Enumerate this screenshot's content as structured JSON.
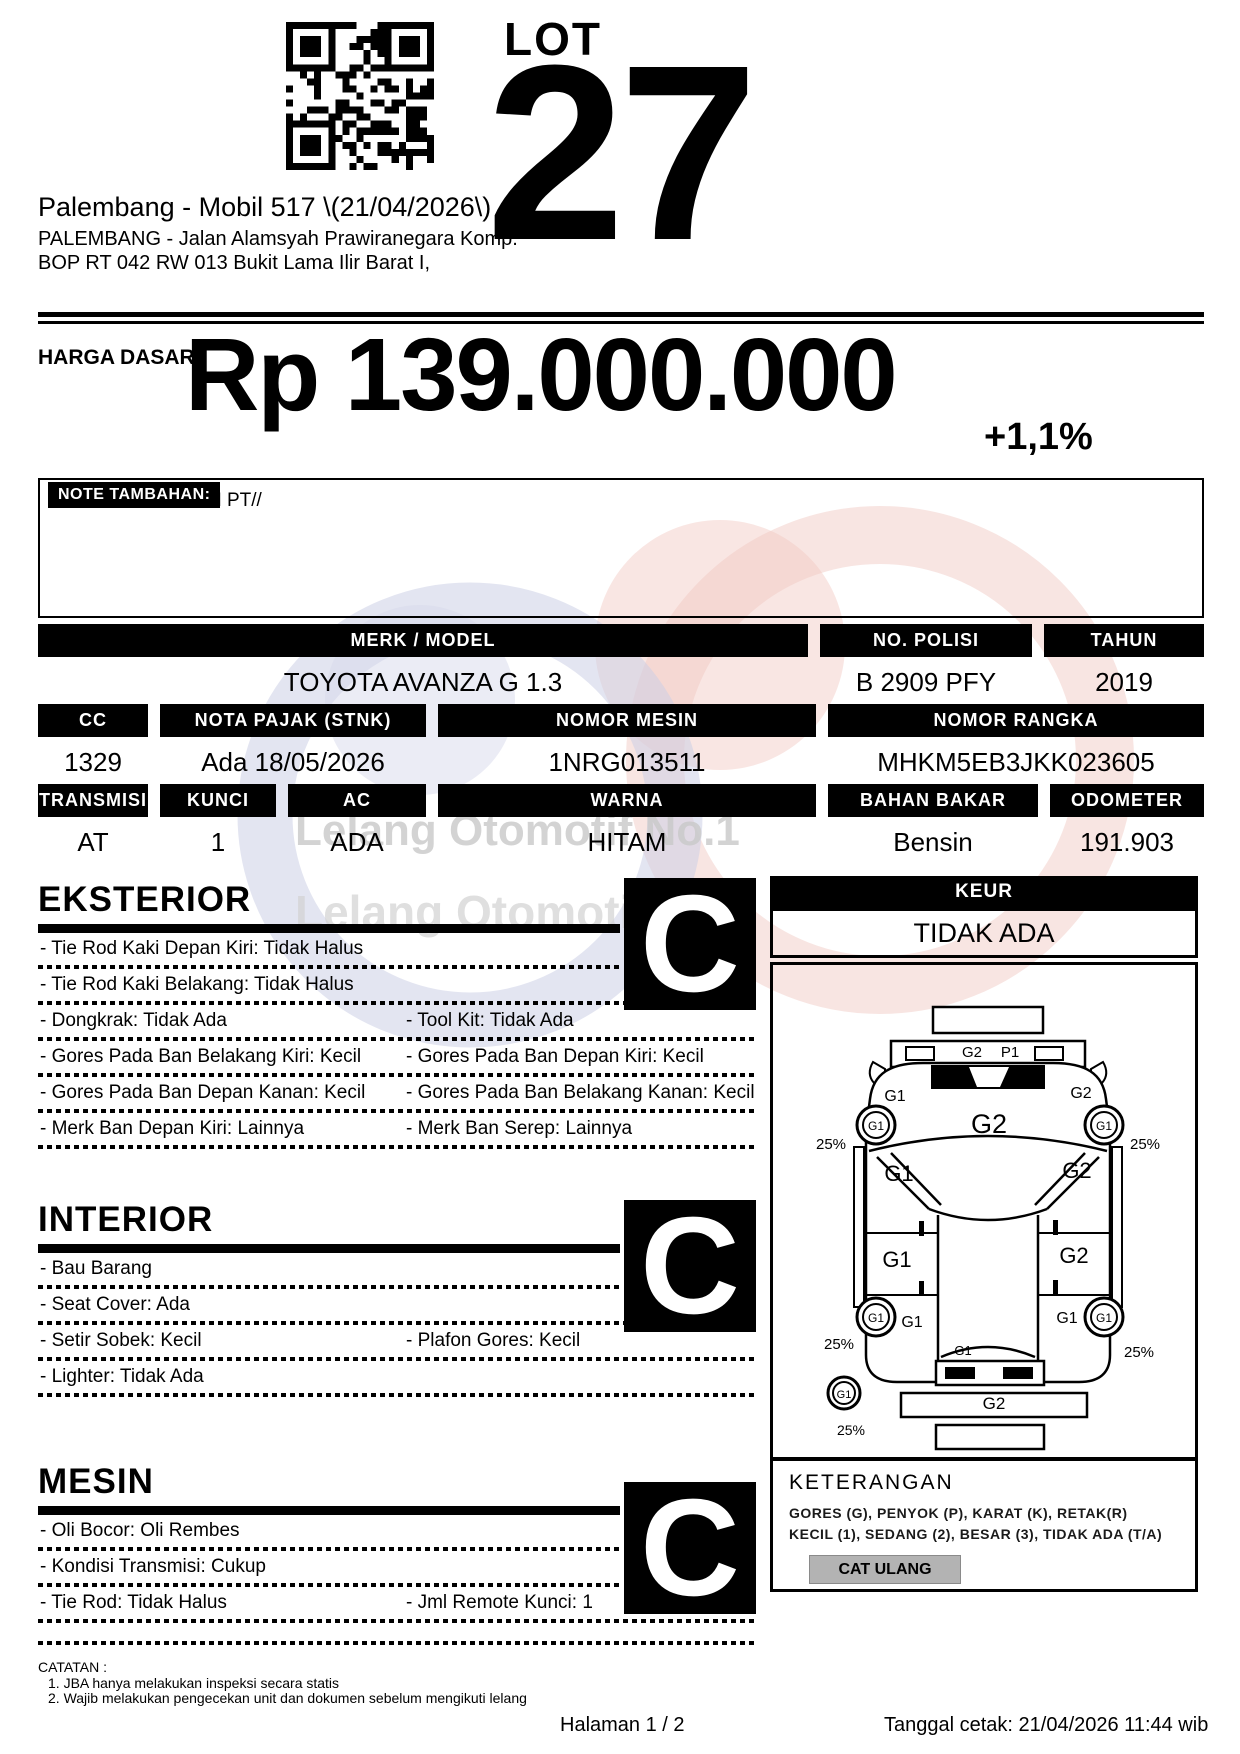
{
  "header": {
    "lot_label": "LOT",
    "lot_number": "27",
    "title": "Palembang - Mobil 517 \\(21/04/2026\\)",
    "address1": "PALEMBANG - Jalan Alamsyah Prawiranegara Komp.",
    "address2": "BOP RT 042 RW 013 Bukit Lama Ilir Barat I,"
  },
  "price": {
    "label": "HARGA DASAR :",
    "value": "Rp 139.000.000",
    "change": "+1,1%"
  },
  "note": {
    "label": "NOTE TAMBAHAN:",
    "text": "A.N PT//"
  },
  "specs": {
    "merk_model": {
      "label": "MERK / MODEL",
      "value": "TOYOTA AVANZA G 1.3"
    },
    "no_polisi": {
      "label": "NO. POLISI",
      "value": "B 2909 PFY"
    },
    "tahun": {
      "label": "TAHUN",
      "value": "2019"
    },
    "cc": {
      "label": "CC",
      "value": "1329"
    },
    "nota_pajak": {
      "label": "NOTA PAJAK (STNK)",
      "value": "Ada 18/05/2026"
    },
    "nomor_mesin": {
      "label": "NOMOR MESIN",
      "value": "1NRG013511"
    },
    "nomor_rangka": {
      "label": "NOMOR RANGKA",
      "value": "MHKM5EB3JKK023605"
    },
    "transmisi": {
      "label": "TRANSMISI",
      "value": "AT"
    },
    "kunci": {
      "label": "KUNCI",
      "value": "1"
    },
    "ac": {
      "label": "AC",
      "value": "ADA"
    },
    "warna": {
      "label": "WARNA",
      "value": "HITAM"
    },
    "bahan_bakar": {
      "label": "BAHAN BAKAR",
      "value": "Bensin"
    },
    "odometer": {
      "label": "ODOMETER",
      "value": "191.903"
    }
  },
  "sections": {
    "eksterior": {
      "title": "EKSTERIOR",
      "grade": "C",
      "rows": [
        {
          "left": "- Tie Rod Kaki Depan Kiri: Tidak Halus",
          "right": ""
        },
        {
          "left": "- Tie Rod Kaki Belakang: Tidak Halus",
          "right": ""
        },
        {
          "left": "- Dongkrak: Tidak Ada",
          "right": "- Tool Kit: Tidak Ada"
        },
        {
          "left": "- Gores Pada Ban Belakang Kiri: Kecil",
          "right": "- Gores Pada Ban Depan Kiri: Kecil"
        },
        {
          "left": "- Gores Pada Ban Depan Kanan: Kecil",
          "right": "- Gores Pada Ban Belakang Kanan: Kecil"
        },
        {
          "left": "- Merk Ban Depan Kiri: Lainnya",
          "right": "- Merk Ban Serep: Lainnya"
        }
      ]
    },
    "interior": {
      "title": "INTERIOR",
      "grade": "C",
      "rows": [
        {
          "left": "- Bau Barang",
          "right": ""
        },
        {
          "left": "- Seat Cover: Ada",
          "right": ""
        },
        {
          "left": "- Setir Sobek: Kecil",
          "right": "- Plafon Gores: Kecil"
        },
        {
          "left": "- Lighter: Tidak Ada",
          "right": ""
        }
      ]
    },
    "mesin": {
      "title": "MESIN",
      "grade": "C",
      "rows": [
        {
          "left": "- Oli Bocor: Oli Rembes",
          "right": ""
        },
        {
          "left": "- Kondisi Transmisi: Cukup",
          "right": ""
        },
        {
          "left": "- Tie Rod: Tidak Halus",
          "right": "- Jml Remote Kunci: 1"
        }
      ]
    }
  },
  "keur": {
    "label": "KEUR",
    "value": "TIDAK ADA"
  },
  "keterangan": {
    "title": "KETERANGAN",
    "line1": "GORES (G), PENYOK (P), KARAT (K), RETAK(R)",
    "line2": "KECIL (1), SEDANG (2), BESAR (3), TIDAK ADA (T/A)",
    "button": "CAT ULANG"
  },
  "diagram": {
    "labels": [
      {
        "t": "G2",
        "x": 199,
        "y": 92,
        "s": 15
      },
      {
        "t": "P1",
        "x": 237,
        "y": 92,
        "s": 15
      },
      {
        "t": "G2",
        "x": 216,
        "y": 168,
        "s": 27
      },
      {
        "t": "G1",
        "x": 122,
        "y": 136,
        "s": 16
      },
      {
        "t": "G2",
        "x": 308,
        "y": 133,
        "s": 16
      },
      {
        "t": "G1",
        "x": 103,
        "y": 165,
        "s": 12
      },
      {
        "t": "G1",
        "x": 331,
        "y": 165,
        "s": 12
      },
      {
        "t": "25%",
        "x": 58,
        "y": 184,
        "s": 15
      },
      {
        "t": "25%",
        "x": 372,
        "y": 184,
        "s": 15
      },
      {
        "t": "G1",
        "x": 126,
        "y": 216,
        "s": 22
      },
      {
        "t": "G2",
        "x": 304,
        "y": 213,
        "s": 22
      },
      {
        "t": "G1",
        "x": 124,
        "y": 302,
        "s": 22
      },
      {
        "t": "G2",
        "x": 301,
        "y": 298,
        "s": 22
      },
      {
        "t": "G1",
        "x": 103,
        "y": 357,
        "s": 12
      },
      {
        "t": "G1",
        "x": 331,
        "y": 357,
        "s": 12
      },
      {
        "t": "G1",
        "x": 139,
        "y": 362,
        "s": 16
      },
      {
        "t": "G1",
        "x": 294,
        "y": 358,
        "s": 16
      },
      {
        "t": "25%",
        "x": 66,
        "y": 384,
        "s": 15
      },
      {
        "t": "25%",
        "x": 366,
        "y": 392,
        "s": 15
      },
      {
        "t": "G1",
        "x": 190,
        "y": 390,
        "s": 13
      },
      {
        "t": "G2",
        "x": 221,
        "y": 444,
        "s": 17
      },
      {
        "t": "G1",
        "x": 71,
        "y": 433,
        "s": 11
      },
      {
        "t": "25%",
        "x": 78,
        "y": 470,
        "s": 14
      }
    ]
  },
  "watermark": {
    "line1": "Lelang Otomotif No.1",
    "line2": "Lelang Otomotif"
  },
  "catatan": {
    "title": "CATATAN :",
    "item1": "1. JBA hanya melakukan inspeksi secara statis",
    "item2": "2. Wajib melakukan pengecekan unit dan dokumen sebelum mengikuti lelang"
  },
  "footer": {
    "page": "Halaman 1 / 2",
    "printed": "Tanggal cetak: 21/04/2026 11:44 wib"
  },
  "colors": {
    "ink": "#000000",
    "paper": "#ffffff",
    "button_gray": "#b3b3b3",
    "wm_pink": "#f2cfca",
    "wm_blue": "#ccd0e6",
    "wm_text": "#cbcbcb"
  }
}
